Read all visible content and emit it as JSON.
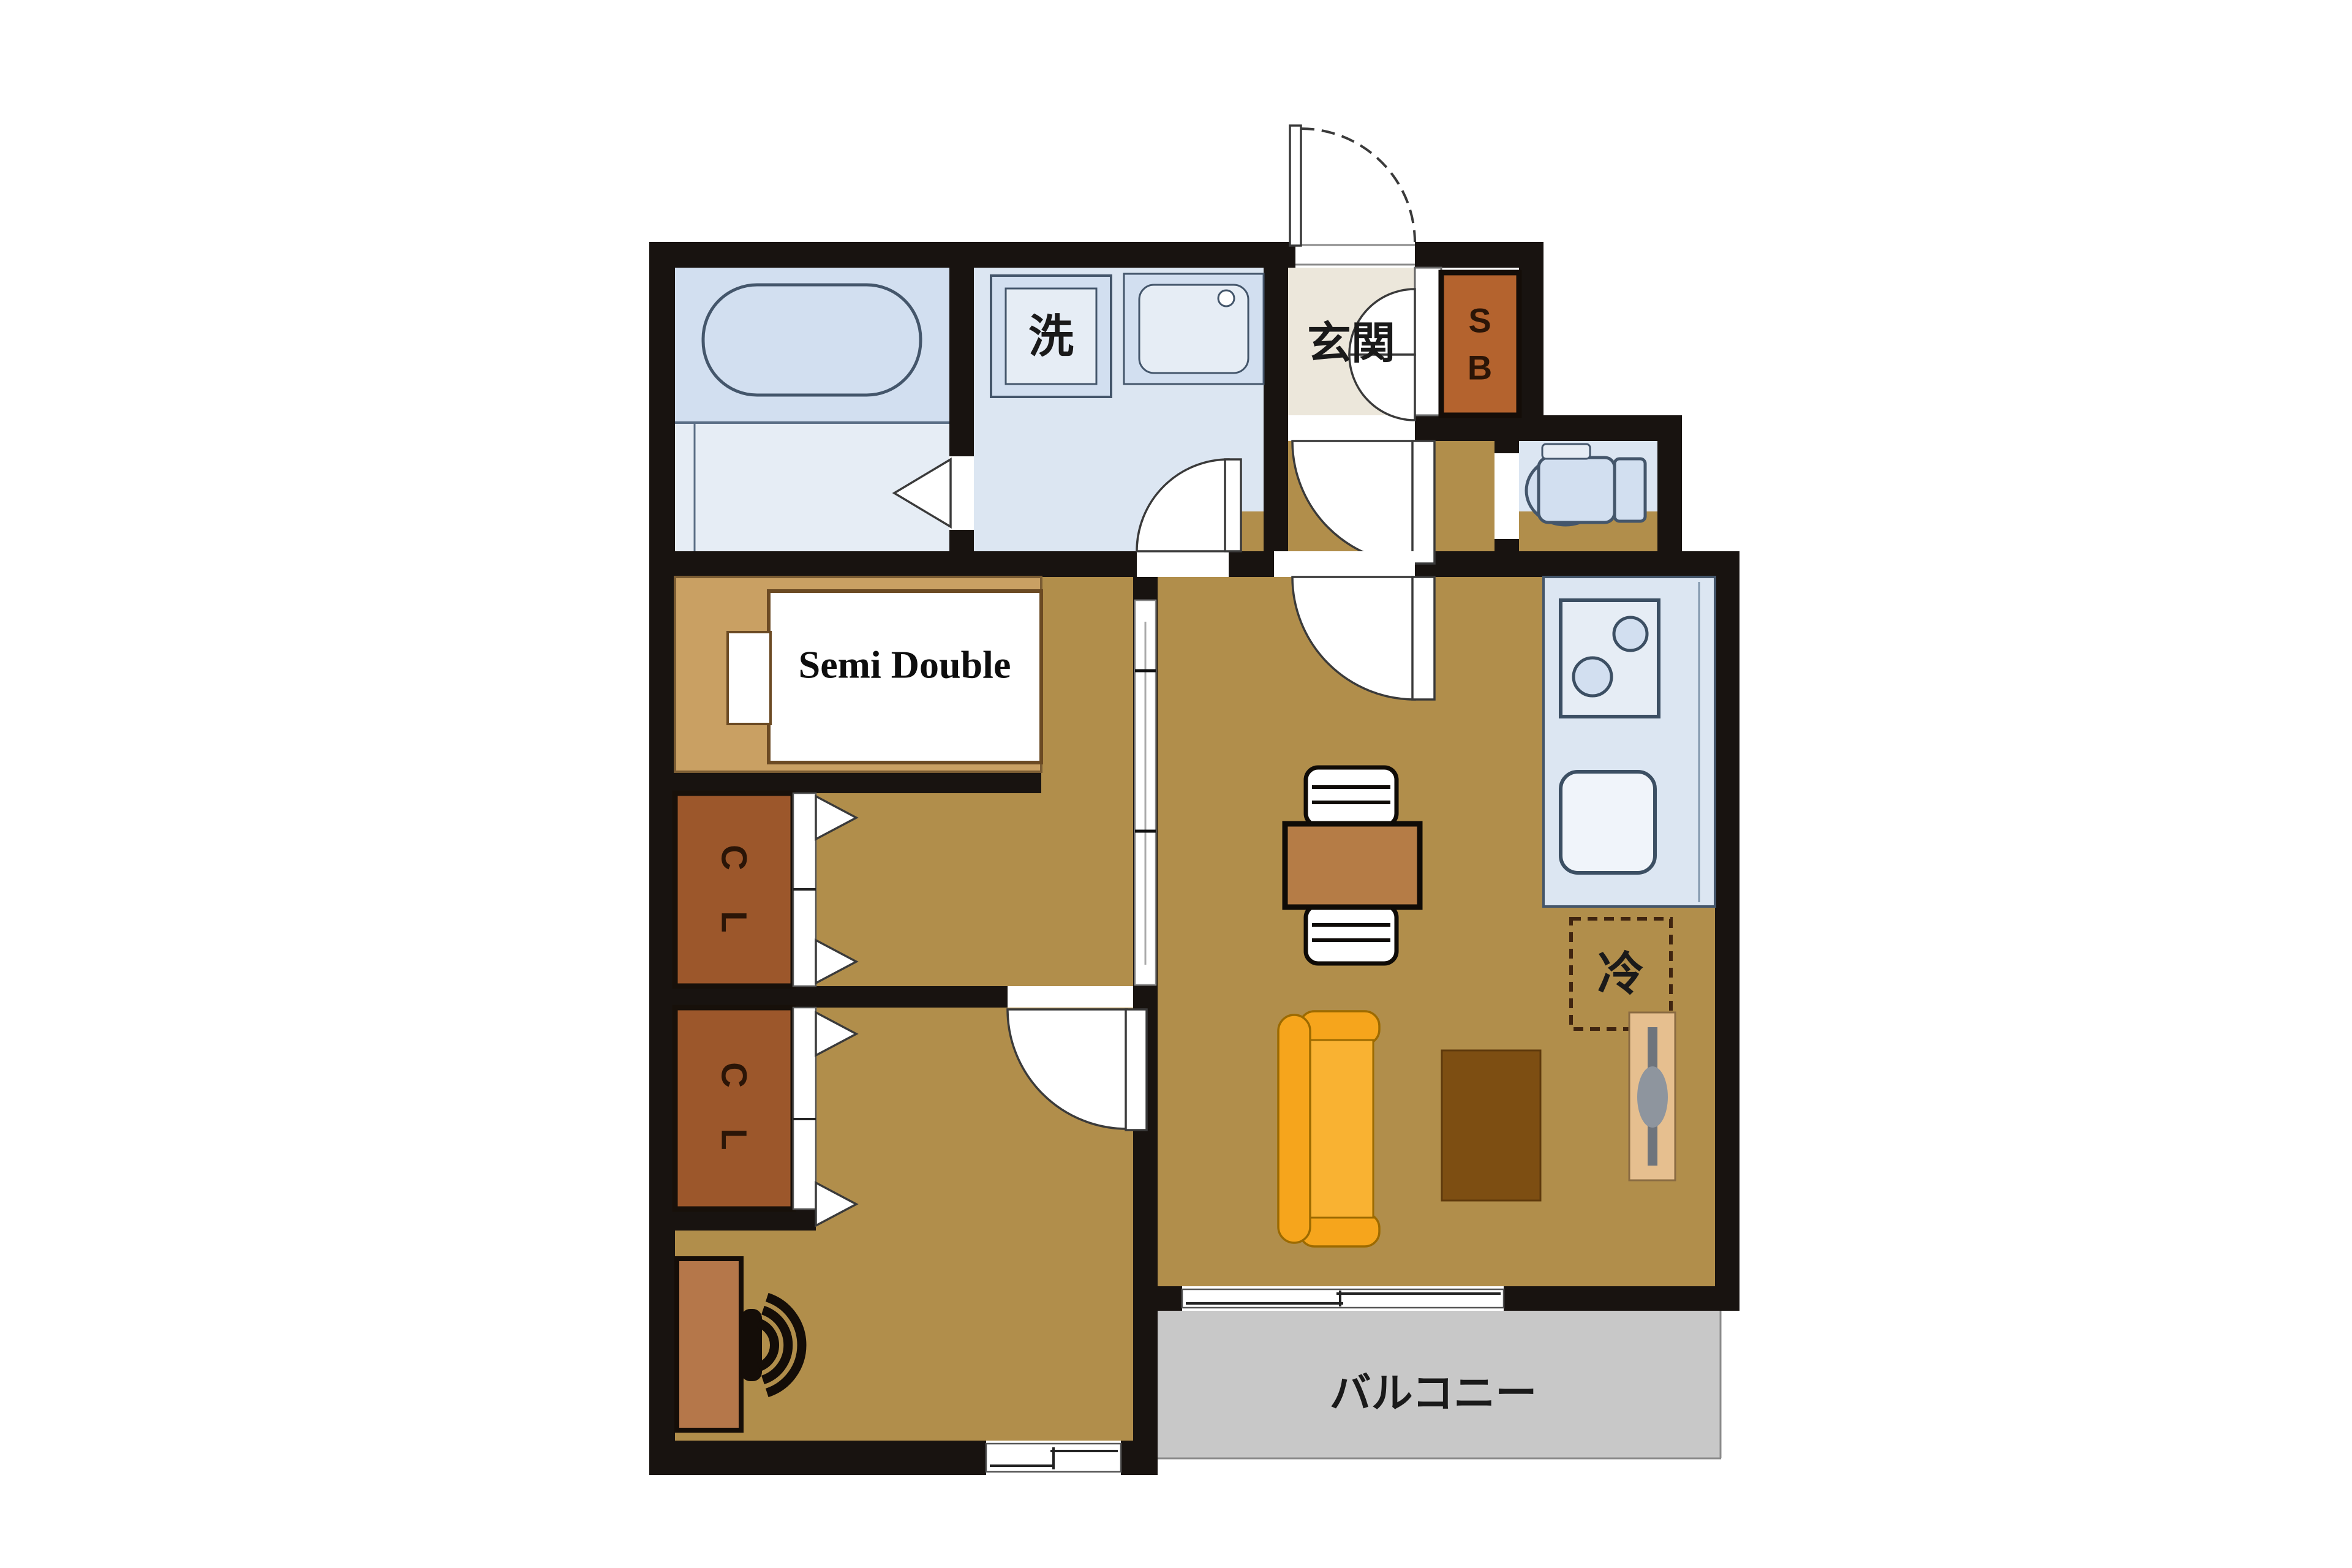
{
  "palette": {
    "wall": "#181310",
    "floor": "#b18e4b",
    "floor-tan": "#c9a063",
    "wet": "#dce6f2",
    "wet-dark": "#d2dff0",
    "wet-light": "#e6edf5",
    "wet-stroke": "#44566b",
    "cream": "#ece7db",
    "closet": "#9c572b",
    "shoebox": "#b4632e",
    "letter-dark": "#2b1507",
    "sofa": "#f6a51c",
    "sofa-seat": "#f9b232",
    "sofa-stroke": "#9c6a00",
    "table": "#b57c46",
    "rug": "#7d4e12",
    "tv-board": "#e6bf8f",
    "desk": "#b5774a",
    "balcony": "#c8c8c8",
    "line-dark": "#222222",
    "bed-stroke": "#6b4a23"
  },
  "labels": {
    "laundry": "洗",
    "entrance": "玄関",
    "shoebox_top": "S",
    "shoebox_bottom": "B",
    "bed": "Semi Double",
    "closet1_top": "C",
    "closet1_bottom": "L",
    "closet2_top": "C",
    "closet2_bottom": "L",
    "refrigerator": "冷",
    "balcony": "バルコニー"
  }
}
